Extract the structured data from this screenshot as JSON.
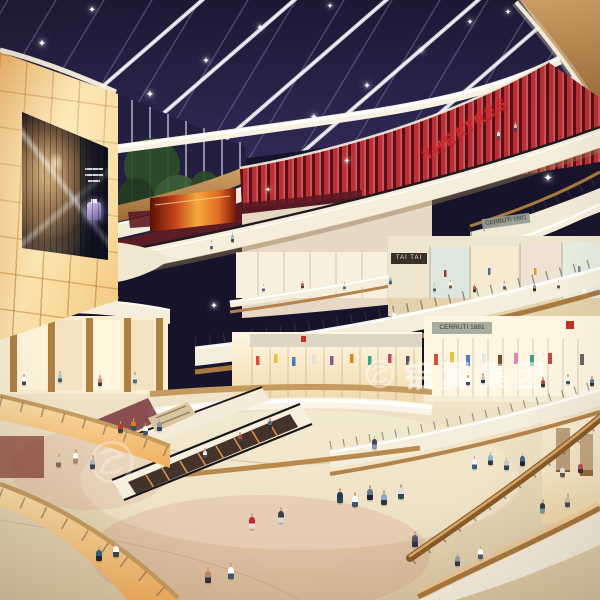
{
  "scene": {
    "type": "3d-architectural-rendering",
    "subject": "Multi-level shopping mall atrium interior with night skylight, escalators and shoppers",
    "watermark_text": "铝翼集团",
    "signs": {
      "theatre_marquee": "THEATRES",
      "store_tai_tai": "TAI TAI",
      "store_upper": "CERRUTI 1881",
      "store_lower": "CERRUTI 1881"
    },
    "palette": {
      "skylight_navy": "#262143",
      "marquee_red": "#c0272d",
      "fascia_cream": "#f5ecd9",
      "wood_accent": "#c1925a",
      "glow_amber": "#f7c98d",
      "floor_beige": "#e8d9bc"
    }
  }
}
